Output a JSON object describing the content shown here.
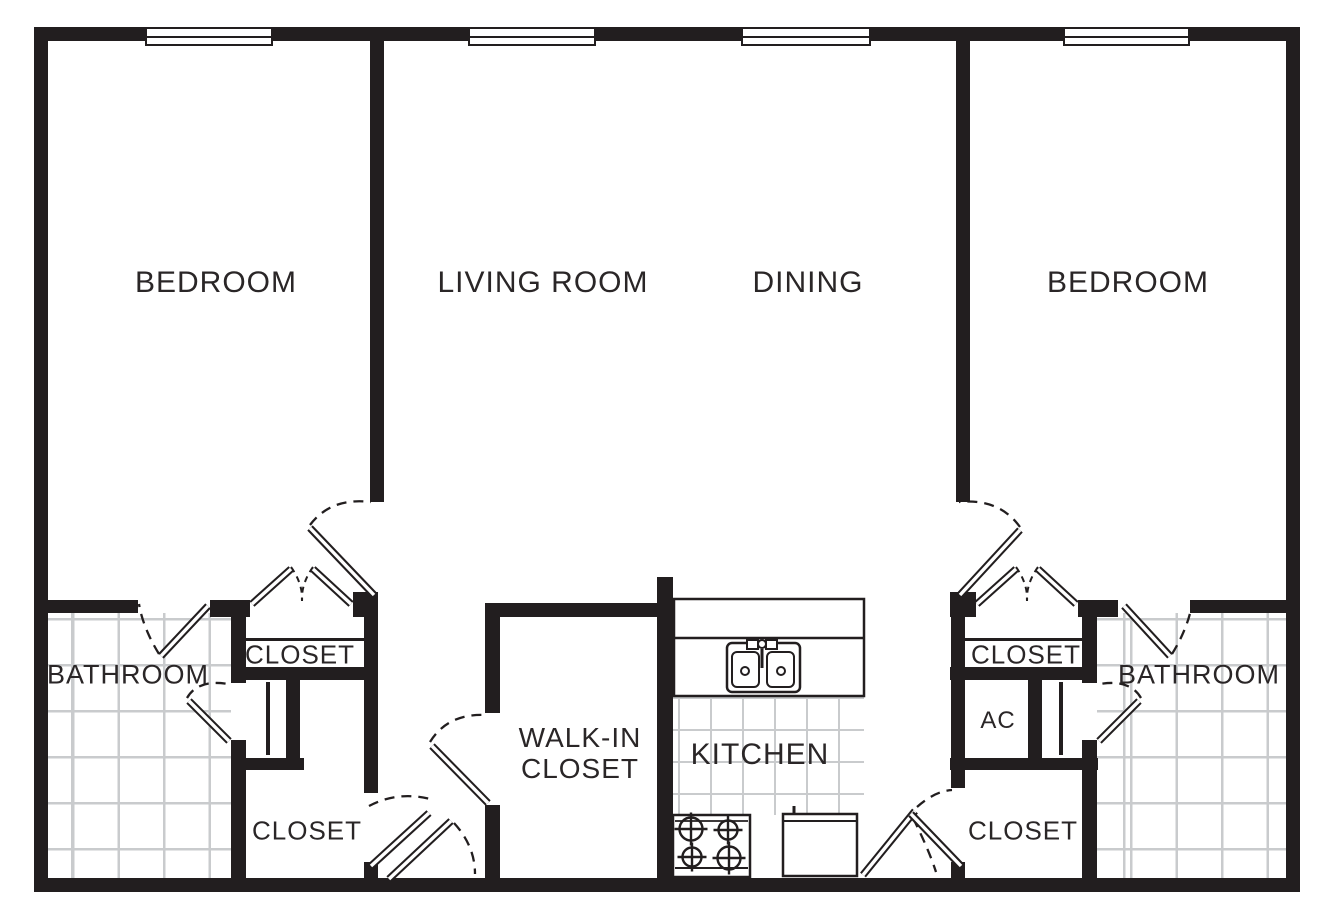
{
  "labels": {
    "bedroom_left": "BEDROOM",
    "living_room": "LIVING ROOM",
    "dining": "DINING",
    "bedroom_right": "BEDROOM",
    "bathroom_left": "BATHROOM",
    "bathroom_right": "BATHROOM",
    "closet_top_left": "CLOSET",
    "closet_bottom_left": "CLOSET",
    "closet_top_right": "CLOSET",
    "closet_bottom_right": "CLOSET",
    "walk_in_closet_line1": "WALK-IN",
    "walk_in_closet_line2": "CLOSET",
    "kitchen": "KITCHEN",
    "ac": "AC"
  },
  "colors": {
    "wall": "#221e1f",
    "tile_line": "#c9cbcd",
    "text": "#2a2627",
    "background": "#ffffff"
  },
  "symbols": {
    "window_icon": "double-line window in wall",
    "door_swing_icon": "angled door leaf with dashed swing arc",
    "bifold_door_icon": "paired door leaves with dashed V swing",
    "sink_icon": "double-basin kitchen sink",
    "stove_icon": "four-burner stove",
    "appliance_icon": "boxed appliance with handle tick",
    "tile_floor_icon": "square grid tile pattern"
  }
}
